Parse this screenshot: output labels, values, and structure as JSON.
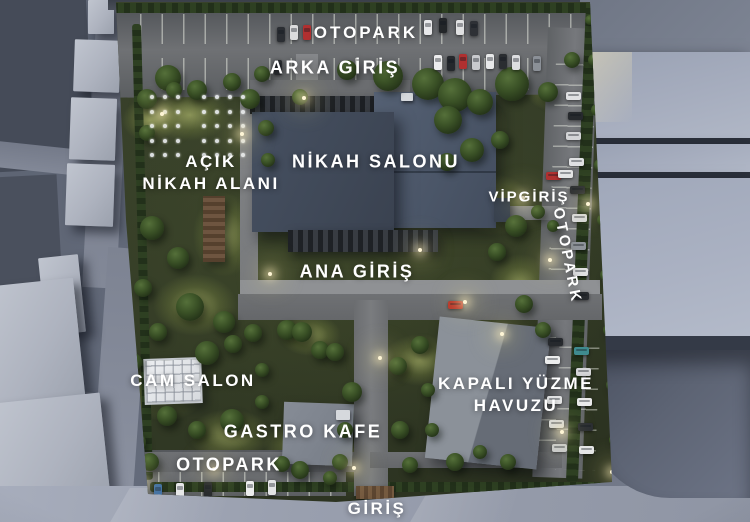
{
  "title": "Nikah Salonu site plan render",
  "labels": {
    "otopark_top": "OTOPARK",
    "arka_giris": "ARKA GİRİŞ",
    "acik_nikah_line1": "AÇIK",
    "acik_nikah_line2": "NİKAH ALANI",
    "nikah_salonu": "NİKAH SALONU",
    "vip_giris": "VİPGİRİŞ",
    "otopark_right": "OTOPARK",
    "ana_giris": "ANA GİRİŞ",
    "cam_salon": "CAM SALON",
    "kapali_yuzme_line1": "KAPALI YÜZME",
    "kapali_yuzme_line2": "HAVUZU",
    "gastro_kafe": "GASTRO KAFE",
    "otopark_bottom": "OTOPARK",
    "giris": "GİRİŞ"
  },
  "colors": {
    "label_text": "#ffffff",
    "main_roof": "#4b5668",
    "grass_dark": "#323a25",
    "grass_lit": "#9aa84f",
    "street": "#767d8d",
    "hedge": "#2e4022",
    "car_red": "#b03030",
    "car_white": "#e8e9ea",
    "car_black": "#26292d",
    "car_blue": "#3d6ea5",
    "car_teal": "#3f8b8f"
  },
  "scene": {
    "trees": [
      [
        168,
        78,
        13
      ],
      [
        197,
        90,
        10
      ],
      [
        232,
        82,
        9
      ],
      [
        262,
        74,
        8
      ],
      [
        300,
        97,
        8
      ],
      [
        347,
        70,
        10
      ],
      [
        388,
        76,
        15
      ],
      [
        428,
        84,
        16
      ],
      [
        455,
        95,
        17
      ],
      [
        480,
        102,
        13
      ],
      [
        512,
        84,
        17
      ],
      [
        548,
        92,
        10
      ],
      [
        572,
        60,
        8
      ],
      [
        147,
        99,
        10
      ],
      [
        174,
        90,
        8
      ],
      [
        250,
        99,
        10
      ],
      [
        266,
        128,
        8
      ],
      [
        147,
        133,
        8
      ],
      [
        268,
        160,
        7
      ],
      [
        152,
        228,
        12
      ],
      [
        178,
        258,
        11
      ],
      [
        143,
        288,
        9
      ],
      [
        190,
        307,
        14
      ],
      [
        224,
        322,
        11
      ],
      [
        158,
        332,
        9
      ],
      [
        133,
        362,
        9
      ],
      [
        253,
        333,
        9
      ],
      [
        287,
        330,
        10
      ],
      [
        320,
        350,
        9
      ],
      [
        207,
        353,
        12
      ],
      [
        233,
        344,
        9
      ],
      [
        167,
        416,
        10
      ],
      [
        197,
        430,
        9
      ],
      [
        232,
        421,
        12
      ],
      [
        137,
        442,
        9
      ],
      [
        262,
        402,
        7
      ],
      [
        150,
        462,
        9
      ],
      [
        302,
        332,
        10
      ],
      [
        335,
        352,
        9
      ],
      [
        398,
        366,
        9
      ],
      [
        352,
        392,
        10
      ],
      [
        300,
        470,
        9
      ],
      [
        282,
        464,
        8
      ],
      [
        330,
        478,
        7
      ],
      [
        262,
        370,
        7
      ],
      [
        345,
        430,
        8
      ],
      [
        400,
        430,
        9
      ],
      [
        420,
        345,
        9
      ],
      [
        428,
        390,
        7
      ],
      [
        432,
        430,
        7
      ],
      [
        455,
        462,
        9
      ],
      [
        480,
        452,
        7
      ],
      [
        508,
        462,
        8
      ],
      [
        448,
        120,
        14
      ],
      [
        472,
        150,
        12
      ],
      [
        500,
        140,
        9
      ],
      [
        447,
        162,
        9
      ],
      [
        516,
        226,
        11
      ],
      [
        497,
        252,
        9
      ],
      [
        524,
        304,
        9
      ],
      [
        543,
        330,
        8
      ],
      [
        538,
        212,
        7
      ],
      [
        553,
        226,
        6
      ],
      [
        340,
        462,
        8
      ],
      [
        410,
        465,
        8
      ],
      [
        594,
        60,
        6
      ],
      [
        597,
        110,
        6
      ],
      [
        600,
        165,
        6
      ],
      [
        603,
        220,
        6
      ],
      [
        606,
        275,
        6
      ],
      [
        609,
        330,
        6
      ],
      [
        612,
        385,
        6
      ],
      [
        615,
        440,
        6
      ],
      [
        590,
        20,
        5
      ]
    ],
    "patches": [
      [
        190,
        115,
        80,
        52
      ],
      [
        225,
        235,
        64,
        84
      ],
      [
        460,
        125,
        95,
        62
      ],
      [
        495,
        205,
        74,
        62
      ],
      [
        520,
        285,
        62,
        62
      ],
      [
        195,
        305,
        84,
        62
      ],
      [
        165,
        390,
        84,
        62
      ],
      [
        230,
        435,
        84,
        52
      ],
      [
        300,
        445,
        74,
        52
      ],
      [
        420,
        360,
        74,
        52
      ],
      [
        310,
        335,
        62,
        42
      ],
      [
        545,
        440,
        62,
        52
      ],
      [
        430,
        90,
        84,
        42
      ],
      [
        552,
        90,
        52,
        42
      ],
      [
        150,
        120,
        56,
        44
      ],
      [
        360,
        460,
        60,
        40
      ]
    ],
    "lights": [
      [
        302,
        96
      ],
      [
        240,
        132
      ],
      [
        160,
        112
      ],
      [
        268,
        272
      ],
      [
        418,
        248
      ],
      [
        521,
        196
      ],
      [
        548,
        258
      ],
      [
        463,
        300
      ],
      [
        378,
        356
      ],
      [
        500,
        332
      ],
      [
        560,
        430
      ],
      [
        352,
        466
      ],
      [
        212,
        467
      ],
      [
        140,
        480
      ],
      [
        586,
        202
      ],
      [
        610,
        470
      ]
    ],
    "cars": [
      [
        277,
        27,
        "v",
        "#2b2e33"
      ],
      [
        290,
        25,
        "v",
        "#dcdcdd"
      ],
      [
        303,
        25,
        "v",
        "#b03030"
      ],
      [
        424,
        20,
        "v",
        "#e8e8ea"
      ],
      [
        439,
        18,
        "v",
        "#232629"
      ],
      [
        456,
        20,
        "v",
        "#e0e1e2"
      ],
      [
        470,
        21,
        "v",
        "#2e3136"
      ],
      [
        274,
        60,
        "v",
        "#2a2d31"
      ],
      [
        434,
        55,
        "v",
        "#ededee"
      ],
      [
        447,
        56,
        "v",
        "#25282c"
      ],
      [
        459,
        54,
        "v",
        "#b03030"
      ],
      [
        472,
        55,
        "v",
        "#c8cacd"
      ],
      [
        486,
        54,
        "v",
        "#e8e9ea"
      ],
      [
        499,
        54,
        "v",
        "#2a2d31"
      ],
      [
        512,
        55,
        "v",
        "#dddee0"
      ],
      [
        533,
        56,
        "v",
        "#8b9097"
      ],
      [
        566,
        92,
        "h",
        "#dfe0e2"
      ],
      [
        568,
        112,
        "h",
        "#26292d"
      ],
      [
        566,
        132,
        "h",
        "#d3d4d6"
      ],
      [
        569,
        158,
        "h",
        "#dfe0e2"
      ],
      [
        570,
        186,
        "h",
        "#2a2d31"
      ],
      [
        572,
        214,
        "h",
        "#d8d9db"
      ],
      [
        571,
        242,
        "h",
        "#8e939a"
      ],
      [
        573,
        268,
        "h",
        "#dfe0e2"
      ],
      [
        574,
        292,
        "h",
        "#26292d"
      ],
      [
        546,
        172,
        "h",
        "#b03030"
      ],
      [
        558,
        170,
        "h",
        "#e3e4e5"
      ],
      [
        448,
        301,
        "h",
        "#b83228"
      ],
      [
        548,
        338,
        "h",
        "#26292d"
      ],
      [
        545,
        356,
        "h",
        "#eceded"
      ],
      [
        574,
        347,
        "h",
        "#3f8b8f"
      ],
      [
        576,
        368,
        "h",
        "#d6d7d9"
      ],
      [
        547,
        396,
        "h",
        "#e3e4e5"
      ],
      [
        577,
        398,
        "h",
        "#eaeaeb"
      ],
      [
        549,
        420,
        "h",
        "#d8d9da"
      ],
      [
        578,
        423,
        "h",
        "#2b2e32"
      ],
      [
        579,
        446,
        "h",
        "#e6e7e8"
      ],
      [
        552,
        444,
        "h",
        "#c9cbcd"
      ],
      [
        154,
        484,
        "v",
        "#3d6ea5"
      ],
      [
        176,
        483,
        "v",
        "#e6e7e8"
      ],
      [
        204,
        482,
        "v",
        "#26292d"
      ],
      [
        246,
        481,
        "v",
        "#eceded"
      ],
      [
        268,
        480,
        "v",
        "#e3e4e5"
      ]
    ],
    "ceremony_dots": {
      "x": 150,
      "y": 95,
      "cols": 8,
      "rows": 5,
      "dx": 13,
      "dy": 14.5,
      "skip_col": 3
    }
  }
}
